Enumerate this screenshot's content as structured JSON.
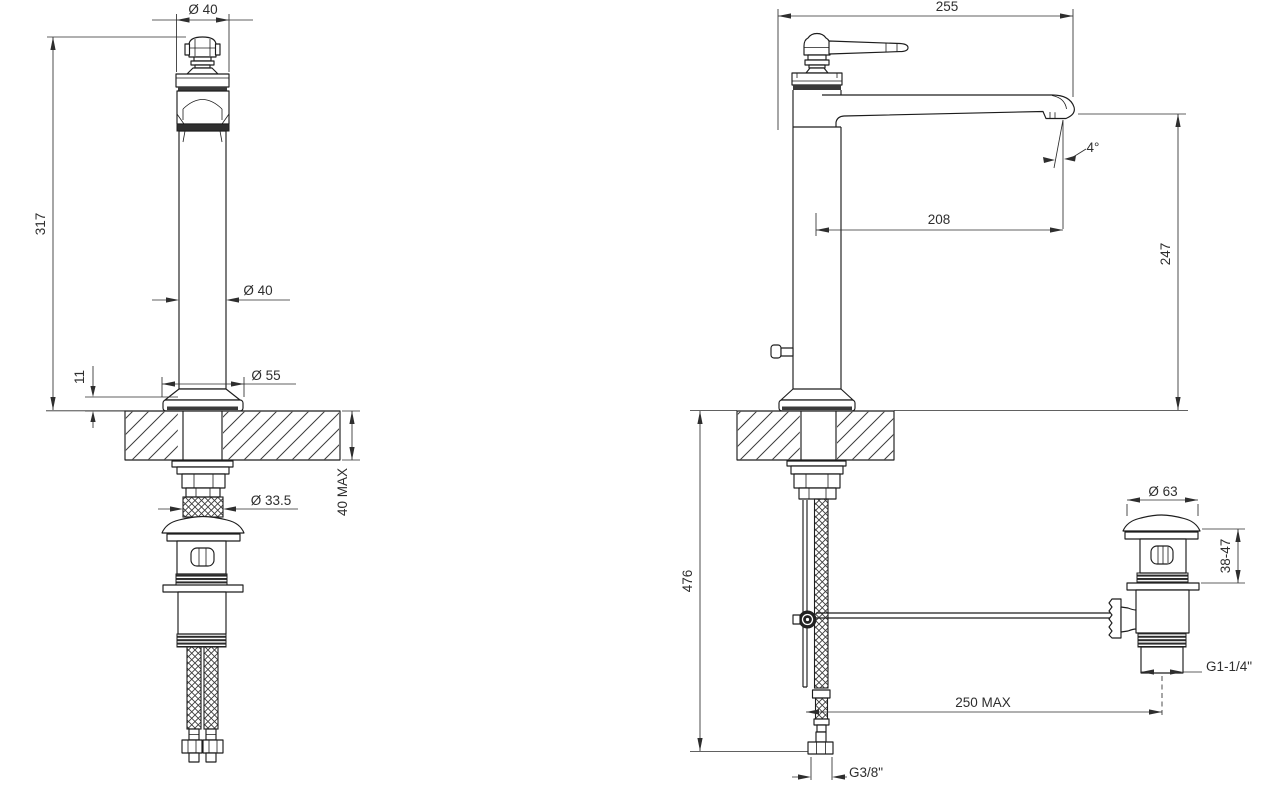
{
  "drawing": {
    "background": "#ffffff",
    "line_color": "#1d1d1d",
    "dimension_color": "#2e2e2e",
    "views": {
      "front": {
        "name": "front view - tall basin mixer with supply hoses and pop-up waste",
        "dims": {
          "top_diameter": "Ø 40",
          "total_height": "317",
          "body_diameter": "Ø 40",
          "base_diameter": "Ø 55",
          "base_lip_height": "11",
          "deck_thickness": "40 MAX",
          "shank_diameter": "Ø 33.5"
        }
      },
      "side": {
        "name": "side view - spout, deck and below-deck installation",
        "dims": {
          "overall_reach": "255",
          "spout_reach": "208",
          "spout_angle": "4°",
          "outlet_height": "247",
          "below_deck_depth": "476",
          "drain_offset": "250 MAX",
          "supply_thread": "G3/8\""
        }
      },
      "drain": {
        "name": "pop-up waste assembly",
        "dims": {
          "cap_diameter": "Ø 63",
          "body_height_range": "38-47",
          "outlet_thread": "G1-1/4\""
        }
      }
    }
  }
}
